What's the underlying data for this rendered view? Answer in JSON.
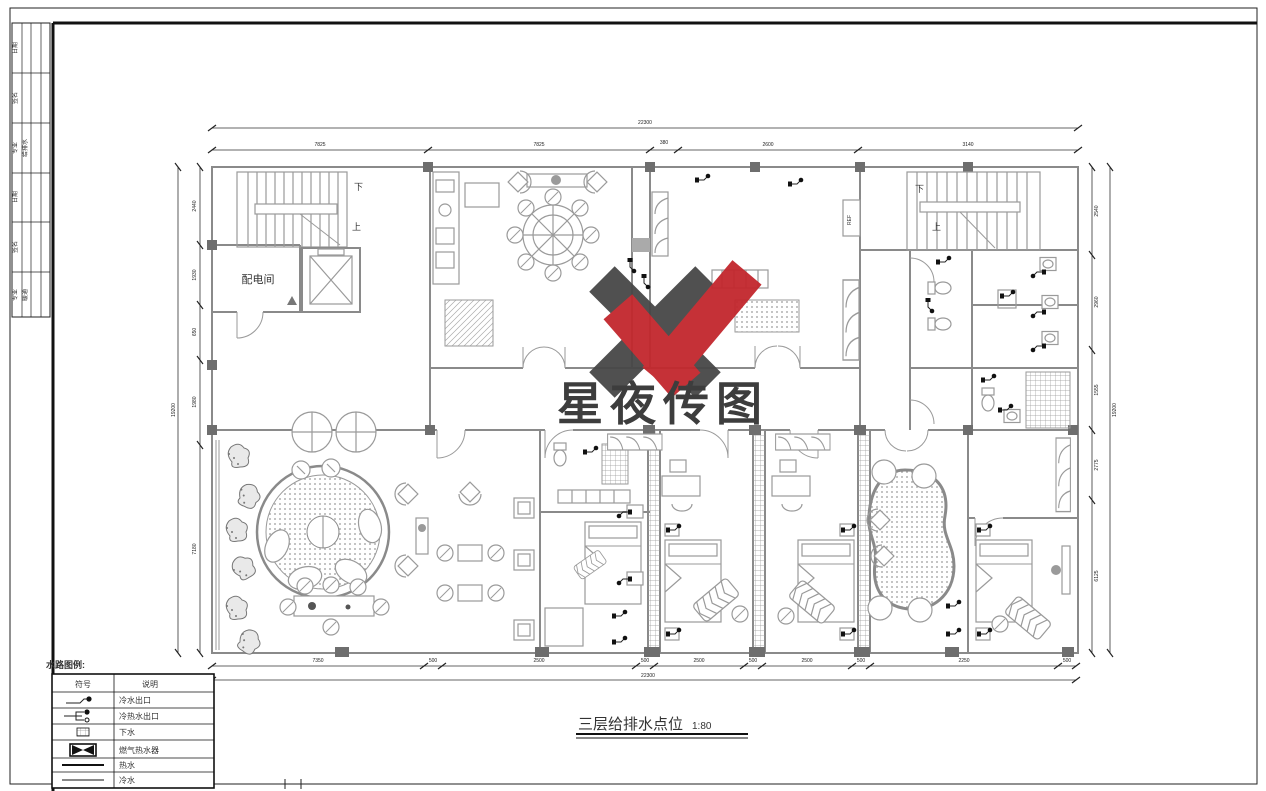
{
  "sheet_title": {
    "text": "三层给排水点位",
    "scale": "1:80"
  },
  "legend": {
    "heading": "水路图例:",
    "columns": {
      "symbol": "符号",
      "description": "说明"
    },
    "rows": [
      {
        "icon": "cold-water-outlet-icon",
        "label": "冷水出口"
      },
      {
        "icon": "hot-cold-water-outlet-icon",
        "label": "冷热水出口"
      },
      {
        "icon": "floor-drain-icon",
        "label": "下水"
      },
      {
        "icon": "gas-water-heater-icon",
        "label": "燃气热水器"
      },
      {
        "icon": "hot-water-line-icon",
        "label": "热水"
      },
      {
        "icon": "cold-water-line-icon",
        "label": "冷水"
      }
    ]
  },
  "watermark": {
    "name": "星夜传图",
    "logo": "XY-check-logo",
    "red": "#c2272d",
    "gray": "#474747"
  },
  "title_block": {
    "rows": [
      "日期",
      "签名",
      "专业",
      "日期",
      "签名",
      "专业"
    ],
    "stamps": [
      "给排水",
      "暖通"
    ]
  },
  "plan_labels": {
    "power_room": "配电间",
    "stair_down": "下",
    "stair_up": "上",
    "fridge": "REF"
  },
  "dims": {
    "top_total": "22300",
    "top_segments": [
      "7825",
      "7825",
      "380",
      "2600",
      "3140"
    ],
    "bottom_segments": [
      "7350",
      "500",
      "2500",
      "500",
      "2500",
      "500",
      "2500",
      "500",
      "2250",
      "500"
    ],
    "bottom_total": "22300",
    "left_total": "19200",
    "left_segments": [
      "2440",
      "1930",
      "650",
      "1980",
      "7180"
    ],
    "right_total": "19200",
    "right_segments": [
      "2540",
      "2960",
      "1555",
      "2775",
      "6125"
    ]
  }
}
